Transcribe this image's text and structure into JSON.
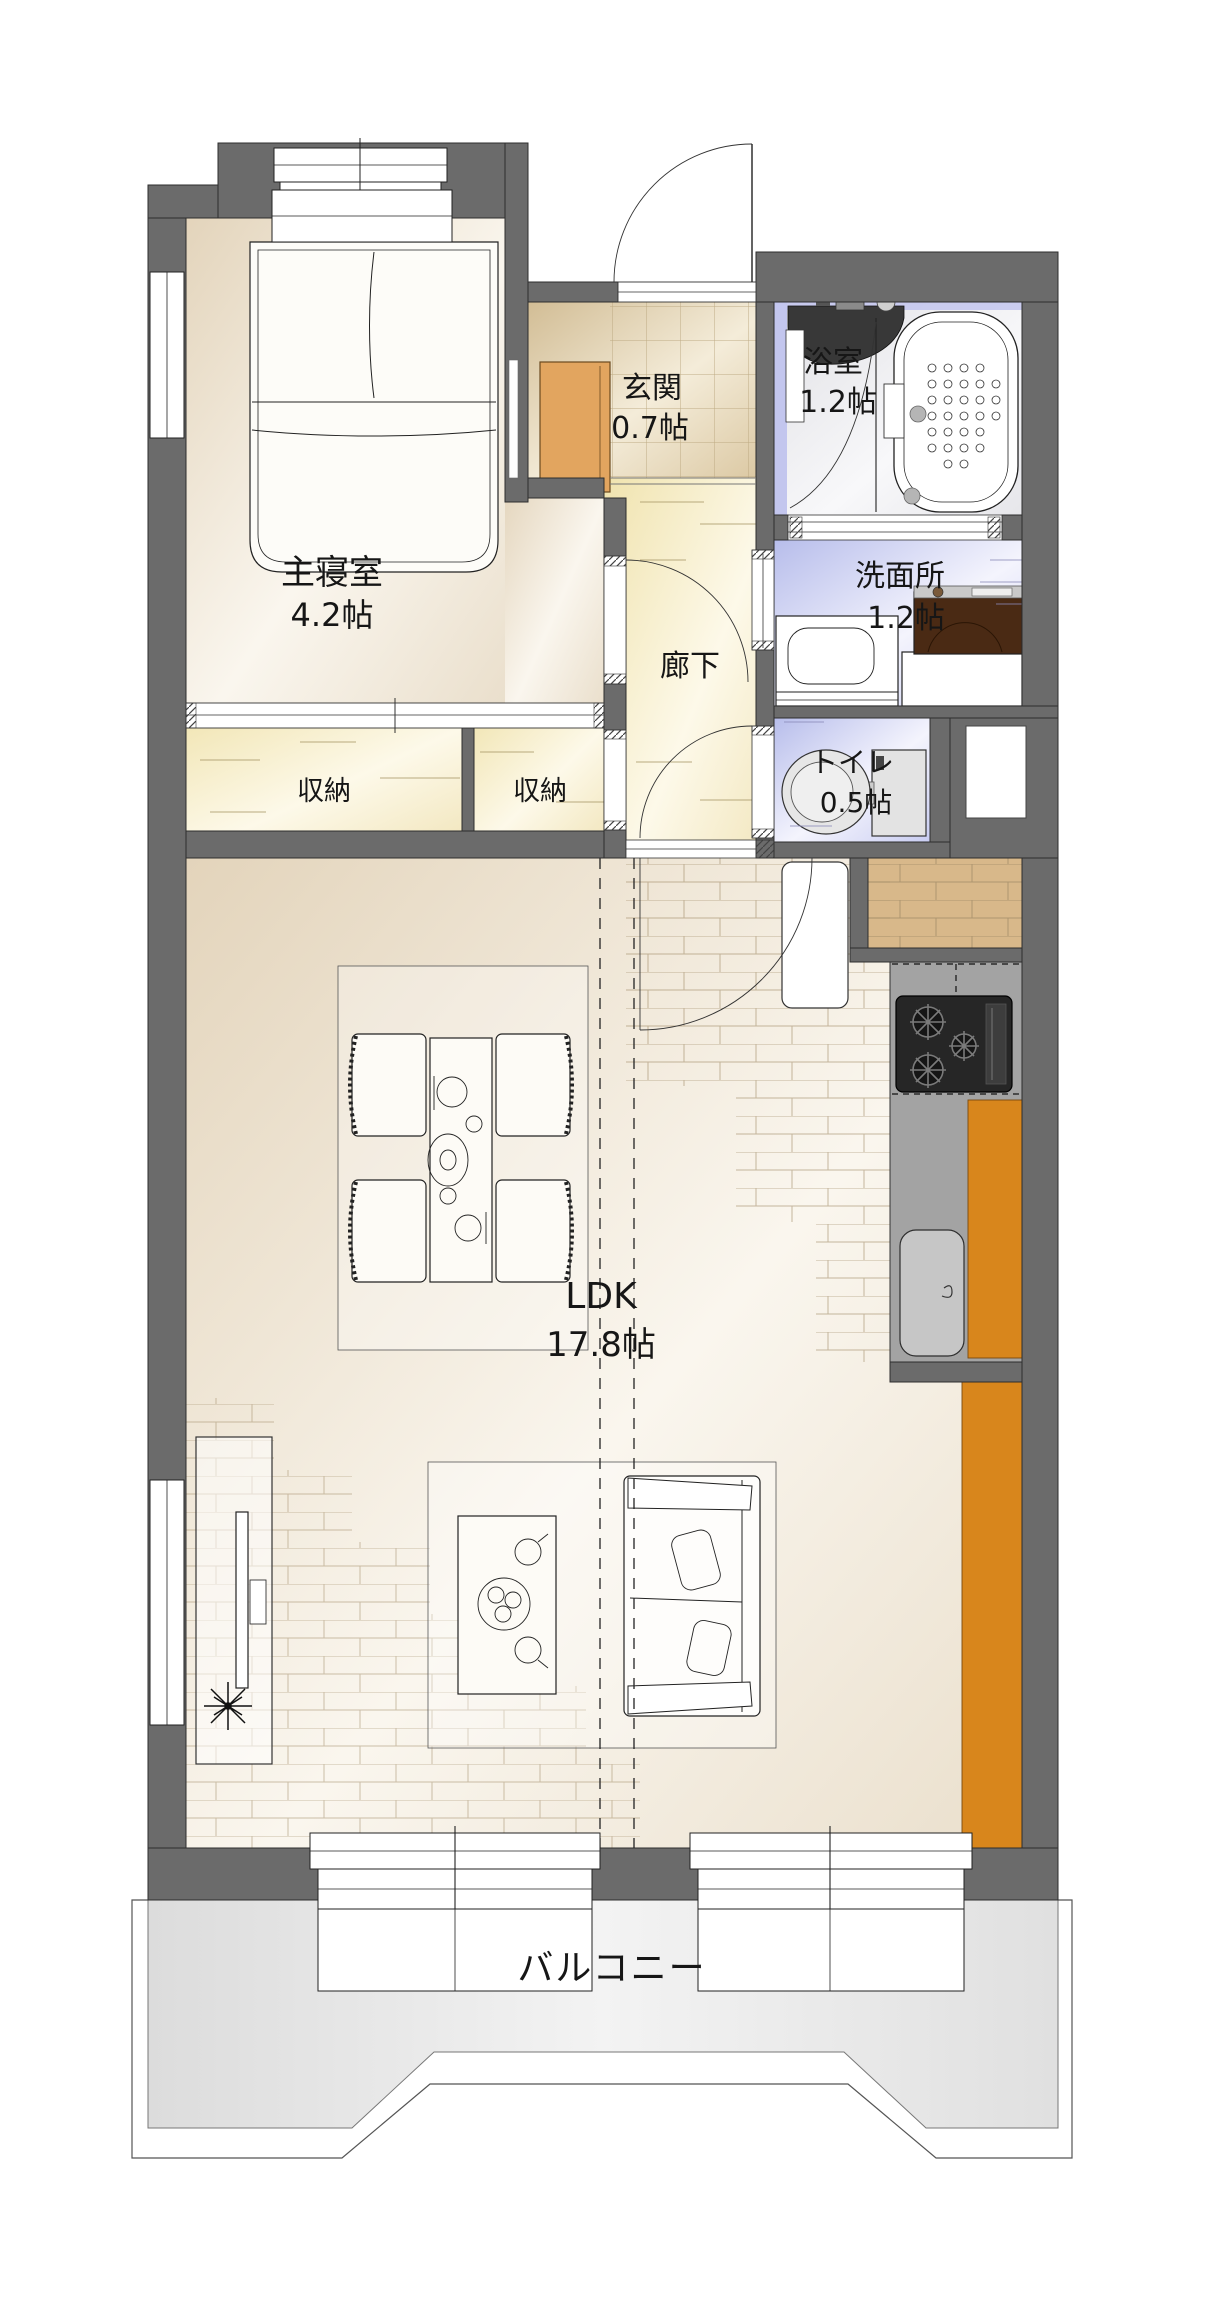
{
  "plan": {
    "type": "floorplan",
    "rooms": {
      "bedroom": {
        "name": "主寝室",
        "size": "4.2帖"
      },
      "entrance": {
        "name": "玄関",
        "size": "0.7帖"
      },
      "bathroom": {
        "name": "浴室",
        "size": "1.2帖"
      },
      "washroom": {
        "name": "洗面所",
        "size": "1.2帖"
      },
      "toilet": {
        "name": "トイレ",
        "size": "0.5帖"
      },
      "hallway": {
        "name": "廊下"
      },
      "storage_left": {
        "name": "収納"
      },
      "storage_right": {
        "name": "収納"
      },
      "ldk": {
        "name": "LDK",
        "size": "17.8帖"
      },
      "balcony": {
        "name": "バルコニー"
      }
    },
    "colors": {
      "wall": "#6b6b6b",
      "floor_beige": "#e6d9c3",
      "floor_yellow": "#f1e6ba",
      "floor_lavender": "#c3c6ee",
      "floor_gray": "#e8e8e8",
      "kitchen_counter": "#a3a3a3",
      "cabinet_orange": "#d8861c",
      "shoe_cabinet": "#e2a55f",
      "wood_floor": "#d8b88a",
      "washer_brown": "#4a2a14"
    }
  }
}
